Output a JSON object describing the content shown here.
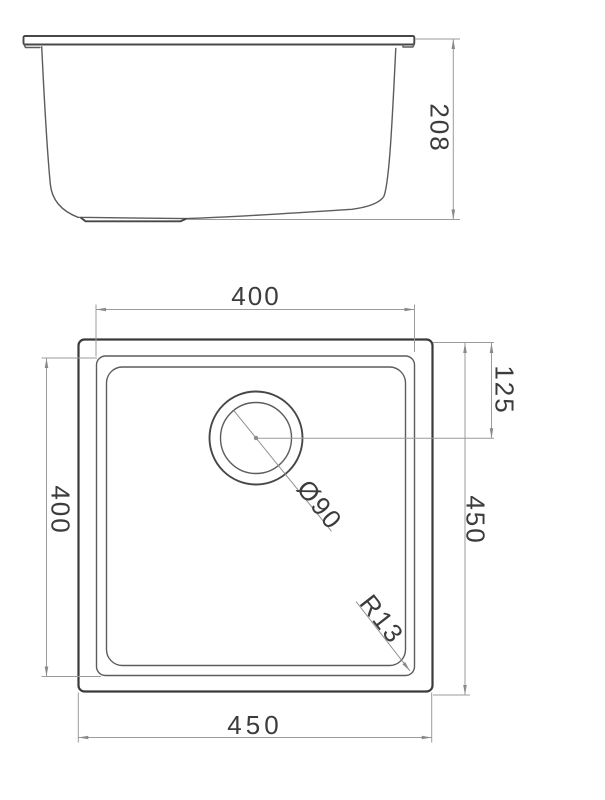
{
  "page": {
    "background_color": "#ffffff",
    "line_color": "#5c5c5c",
    "dimension_line_color": "#9b9b9b",
    "text_color": "#3c3c3c"
  },
  "side_view": {
    "depth_label": "208"
  },
  "plan_view": {
    "bowl_width_label": "400",
    "bowl_height_label": "400",
    "overall_width_label": "450",
    "overall_height_label": "450",
    "drain_offset_label": "125",
    "drain_diameter_label": "Ø90",
    "corner_radius_label": "R13"
  }
}
